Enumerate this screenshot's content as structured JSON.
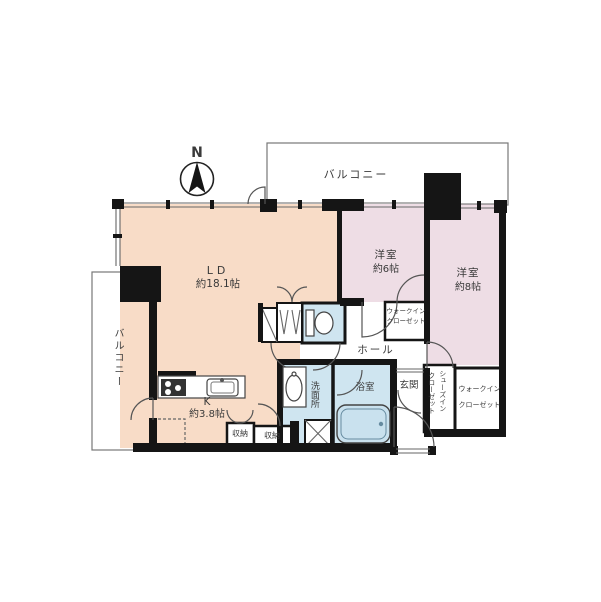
{
  "compass": {
    "north_label": "N"
  },
  "balcony_top": {
    "label": "バルコニー"
  },
  "balcony_left": {
    "label": "バルコニー"
  },
  "colors": {
    "living_dining_kitchen": "#f8dcc7",
    "bedroom": "#eedde5",
    "wet_area": "#cfe5f0",
    "bathtub": "#c9e1ee",
    "wall": "#151515"
  },
  "rooms": {
    "ld": {
      "name": "LD",
      "size": "約18.1帖"
    },
    "kitchen": {
      "name": "K",
      "size": "約3.8帖"
    },
    "bedroom6": {
      "name": "洋室",
      "size": "約6帖"
    },
    "bedroom8": {
      "name": "洋室",
      "size": "約8帖"
    },
    "hall": {
      "name": "ホール"
    },
    "entrance": {
      "name": "玄関"
    },
    "bath": {
      "name": "浴室"
    },
    "washroom": {
      "name": "洗面所"
    },
    "wic6": {
      "line1": "ウォークイン",
      "line2": "クローゼット"
    },
    "wic8": {
      "line1": "ウォークイン",
      "line2": "クローゼット"
    },
    "sic": {
      "line1": "シューズイン",
      "line2": "クローゼット"
    },
    "storage1": {
      "name": "収納"
    },
    "storage2": {
      "name": "収納"
    }
  }
}
